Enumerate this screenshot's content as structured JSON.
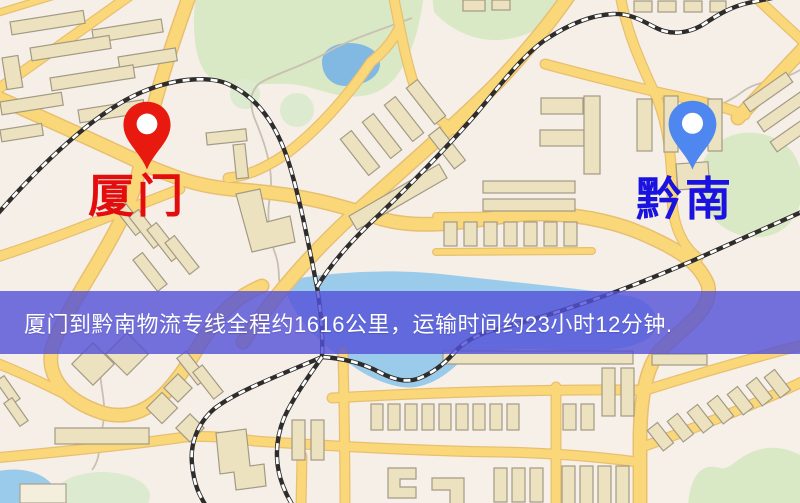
{
  "map": {
    "origin": {
      "name": "厦门",
      "pin_icon": "red-location-pin-icon",
      "pin_color": "#e8190f",
      "label_color": "#e30d0d"
    },
    "destination": {
      "name": "黔南",
      "pin_icon": "blue-location-pin-icon",
      "pin_color": "#4e87ef",
      "label_color": "#1a13e0"
    }
  },
  "banner": {
    "text": "厦门到黔南物流专线全程约1616公里，运输时间约23小时12分钟.",
    "background_color": "#5250d8",
    "text_color": "#ffffff"
  }
}
